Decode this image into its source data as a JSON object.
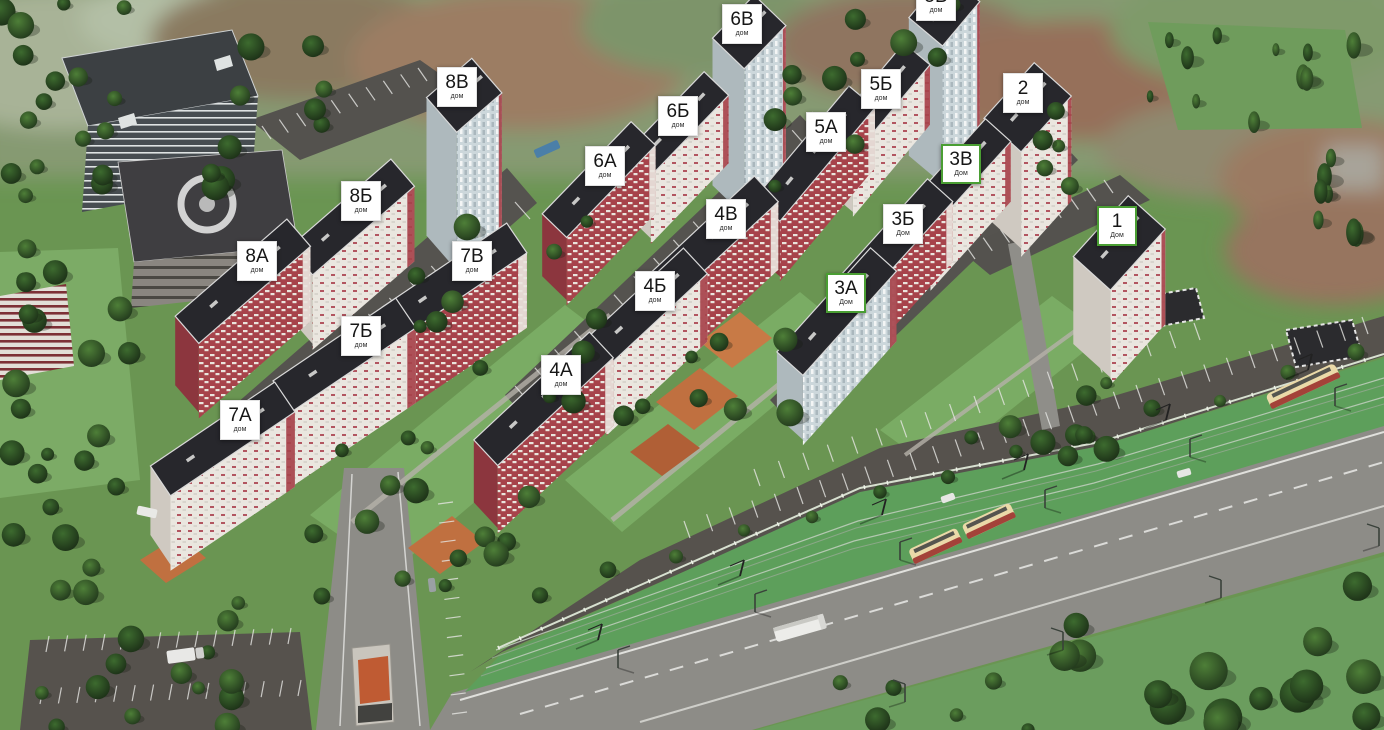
{
  "view": {
    "description": "Aerial 3D render of residential complex master plan with clickable building labels",
    "width": 1384,
    "height": 730
  },
  "colors": {
    "label_bg": "#ffffff",
    "label_border": "#e3e3e3",
    "label_text": "#161616",
    "highlight_green": "#4a9e33",
    "facade_red": "#a7434b",
    "facade_white": "#eae6df",
    "facade_blue": "#ccd7db",
    "roof_dark": "#27272c",
    "grass": "#6a9552",
    "asphalt_road": "#8d8c87",
    "asphalt_parking": "#56524d",
    "tram_lane_green": "#5d9f5b",
    "playground_orange": "#c07040"
  },
  "labels": [
    {
      "id": "6v",
      "num": "6В",
      "sub": "дом",
      "x": 742,
      "y": 24,
      "highlighted": false
    },
    {
      "id": "5v",
      "num": "5В",
      "sub": "дом",
      "x": 936,
      "y": 1,
      "highlighted": false
    },
    {
      "id": "8v",
      "num": "8В",
      "sub": "дом",
      "x": 457,
      "y": 87,
      "highlighted": false
    },
    {
      "id": "5b",
      "num": "5Б",
      "sub": "дом",
      "x": 881,
      "y": 89,
      "highlighted": false
    },
    {
      "id": "2",
      "num": "2",
      "sub": "дом",
      "x": 1023,
      "y": 93,
      "highlighted": false
    },
    {
      "id": "6b",
      "num": "6Б",
      "sub": "дом",
      "x": 678,
      "y": 116,
      "highlighted": false
    },
    {
      "id": "5a",
      "num": "5А",
      "sub": "дом",
      "x": 826,
      "y": 132,
      "highlighted": false
    },
    {
      "id": "3v",
      "num": "3В",
      "sub": "Дом",
      "x": 961,
      "y": 164,
      "highlighted": true
    },
    {
      "id": "6a",
      "num": "6А",
      "sub": "дом",
      "x": 605,
      "y": 166,
      "highlighted": false
    },
    {
      "id": "8b",
      "num": "8Б",
      "sub": "дом",
      "x": 361,
      "y": 201,
      "highlighted": false
    },
    {
      "id": "4v",
      "num": "4В",
      "sub": "дом",
      "x": 726,
      "y": 219,
      "highlighted": false
    },
    {
      "id": "3b",
      "num": "3Б",
      "sub": "Дом",
      "x": 903,
      "y": 224,
      "highlighted": false
    },
    {
      "id": "1",
      "num": "1",
      "sub": "Дом",
      "x": 1117,
      "y": 226,
      "highlighted": true
    },
    {
      "id": "8a",
      "num": "8А",
      "sub": "дом",
      "x": 257,
      "y": 261,
      "highlighted": false
    },
    {
      "id": "7v",
      "num": "7В",
      "sub": "дом",
      "x": 472,
      "y": 261,
      "highlighted": false
    },
    {
      "id": "4b",
      "num": "4Б",
      "sub": "дом",
      "x": 655,
      "y": 291,
      "highlighted": false
    },
    {
      "id": "3a",
      "num": "3А",
      "sub": "Дом",
      "x": 846,
      "y": 293,
      "highlighted": true
    },
    {
      "id": "7b",
      "num": "7Б",
      "sub": "дом",
      "x": 361,
      "y": 336,
      "highlighted": false
    },
    {
      "id": "4a",
      "num": "4А",
      "sub": "дом",
      "x": 561,
      "y": 375,
      "highlighted": false
    },
    {
      "id": "7a",
      "num": "7А",
      "sub": "дом",
      "x": 240,
      "y": 420,
      "highlighted": false
    }
  ]
}
